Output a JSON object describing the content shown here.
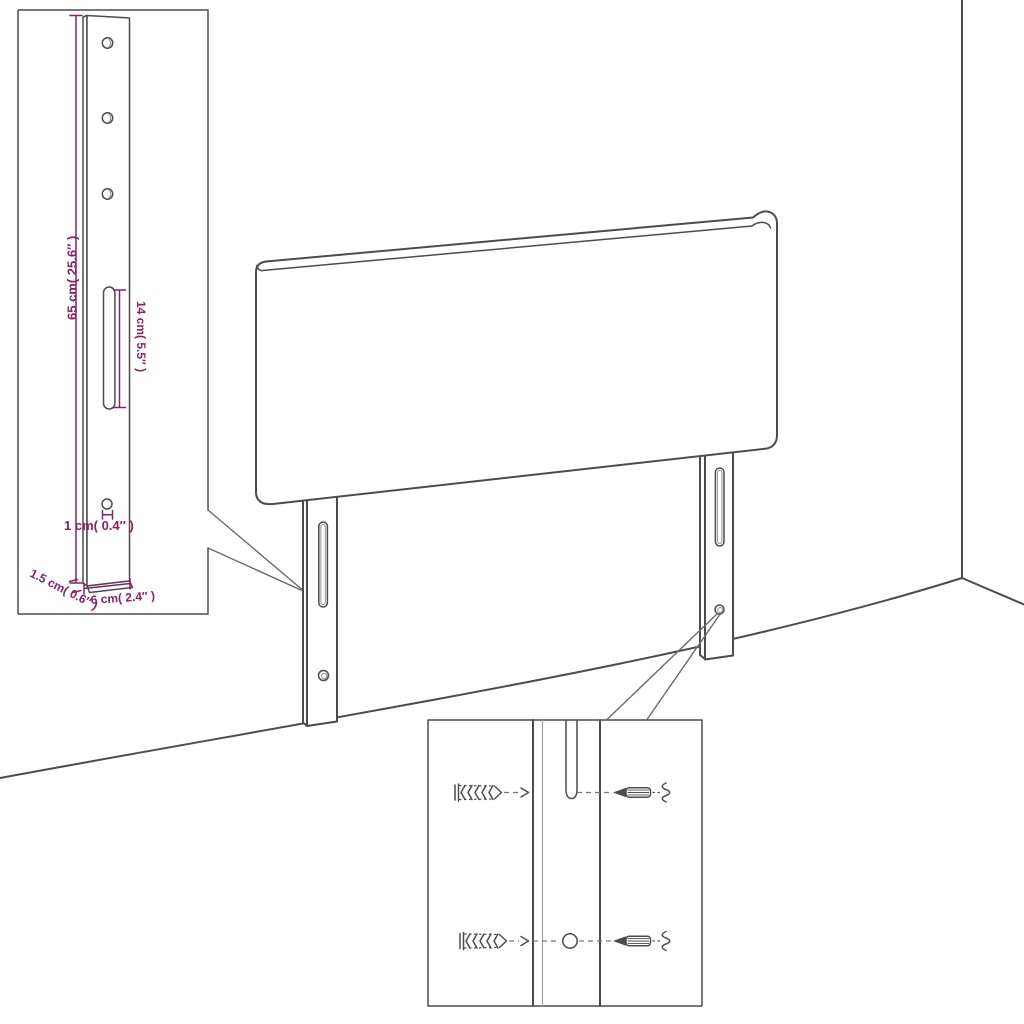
{
  "figure": {
    "kind": "furniture-assembly-dimension-diagram",
    "subject": "upholstered headboard with two slotted mounting legs shown in a room corner",
    "background_color": "#ffffff",
    "line_color": "#4c4c4c",
    "dimension_color": "#8a2165"
  },
  "leg_detail_inset": {
    "name": "leg side-view dimension detail",
    "dimensions": {
      "leg_height": "65 cm( 25.6″ )",
      "slot_length": "14 cm( 5.5″ )",
      "hole_diameter": "1 cm( 0.4″ )",
      "leg_depth": "1.5 cm( 0.6″ )",
      "leg_width": "6 cm( 2.4″ )"
    },
    "features": [
      "screw-hole-icon",
      "screw-hole-icon",
      "screw-hole-icon",
      "adjustment-slot-icon",
      "screw-hole-icon"
    ]
  },
  "hardware_detail_inset": {
    "name": "wall mounting hardware detail",
    "rows": [
      {
        "wall_anchor": "wall-plug-icon",
        "leg_feature": "adjustment-slot-icon",
        "fastener": "screw-icon"
      },
      {
        "wall_anchor": "wall-plug-icon",
        "leg_feature": "screw-hole-icon",
        "fastener": "screw-icon"
      }
    ]
  }
}
